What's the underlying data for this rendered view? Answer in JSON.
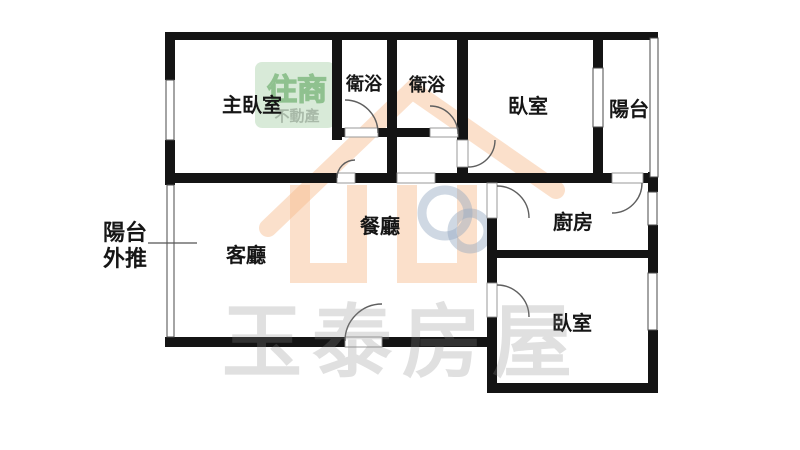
{
  "image_type": "real-estate-floor-plan",
  "floorplan": {
    "rooms": [
      {
        "id": "master-bedroom",
        "label": "主臥室"
      },
      {
        "id": "bathroom-1",
        "label": "衛浴"
      },
      {
        "id": "bathroom-2",
        "label": "衛浴"
      },
      {
        "id": "bedroom-top",
        "label": "臥室"
      },
      {
        "id": "balcony",
        "label": "陽台"
      },
      {
        "id": "living-room",
        "label": "客廳"
      },
      {
        "id": "dining-room",
        "label": "餐廳"
      },
      {
        "id": "kitchen",
        "label": "廚房"
      },
      {
        "id": "bedroom-bottom",
        "label": "臥室"
      }
    ],
    "annotation": {
      "balcony_extension_line1": "陽台",
      "balcony_extension_line2": "外推"
    },
    "watermarks": {
      "badge_line1": "住商",
      "badge_line2": "不動產",
      "agency_name": "玉泰房屋"
    },
    "colors": {
      "wall": "#141414",
      "badge_green_bg": "#cfe6cf",
      "badge_green_text": "#74b274",
      "badge_gray_green": "#93a893",
      "logo_orange": "#f6ba8c",
      "logo_blue": "#94a8c0",
      "watermark_gray": "#8a8a8a"
    }
  }
}
